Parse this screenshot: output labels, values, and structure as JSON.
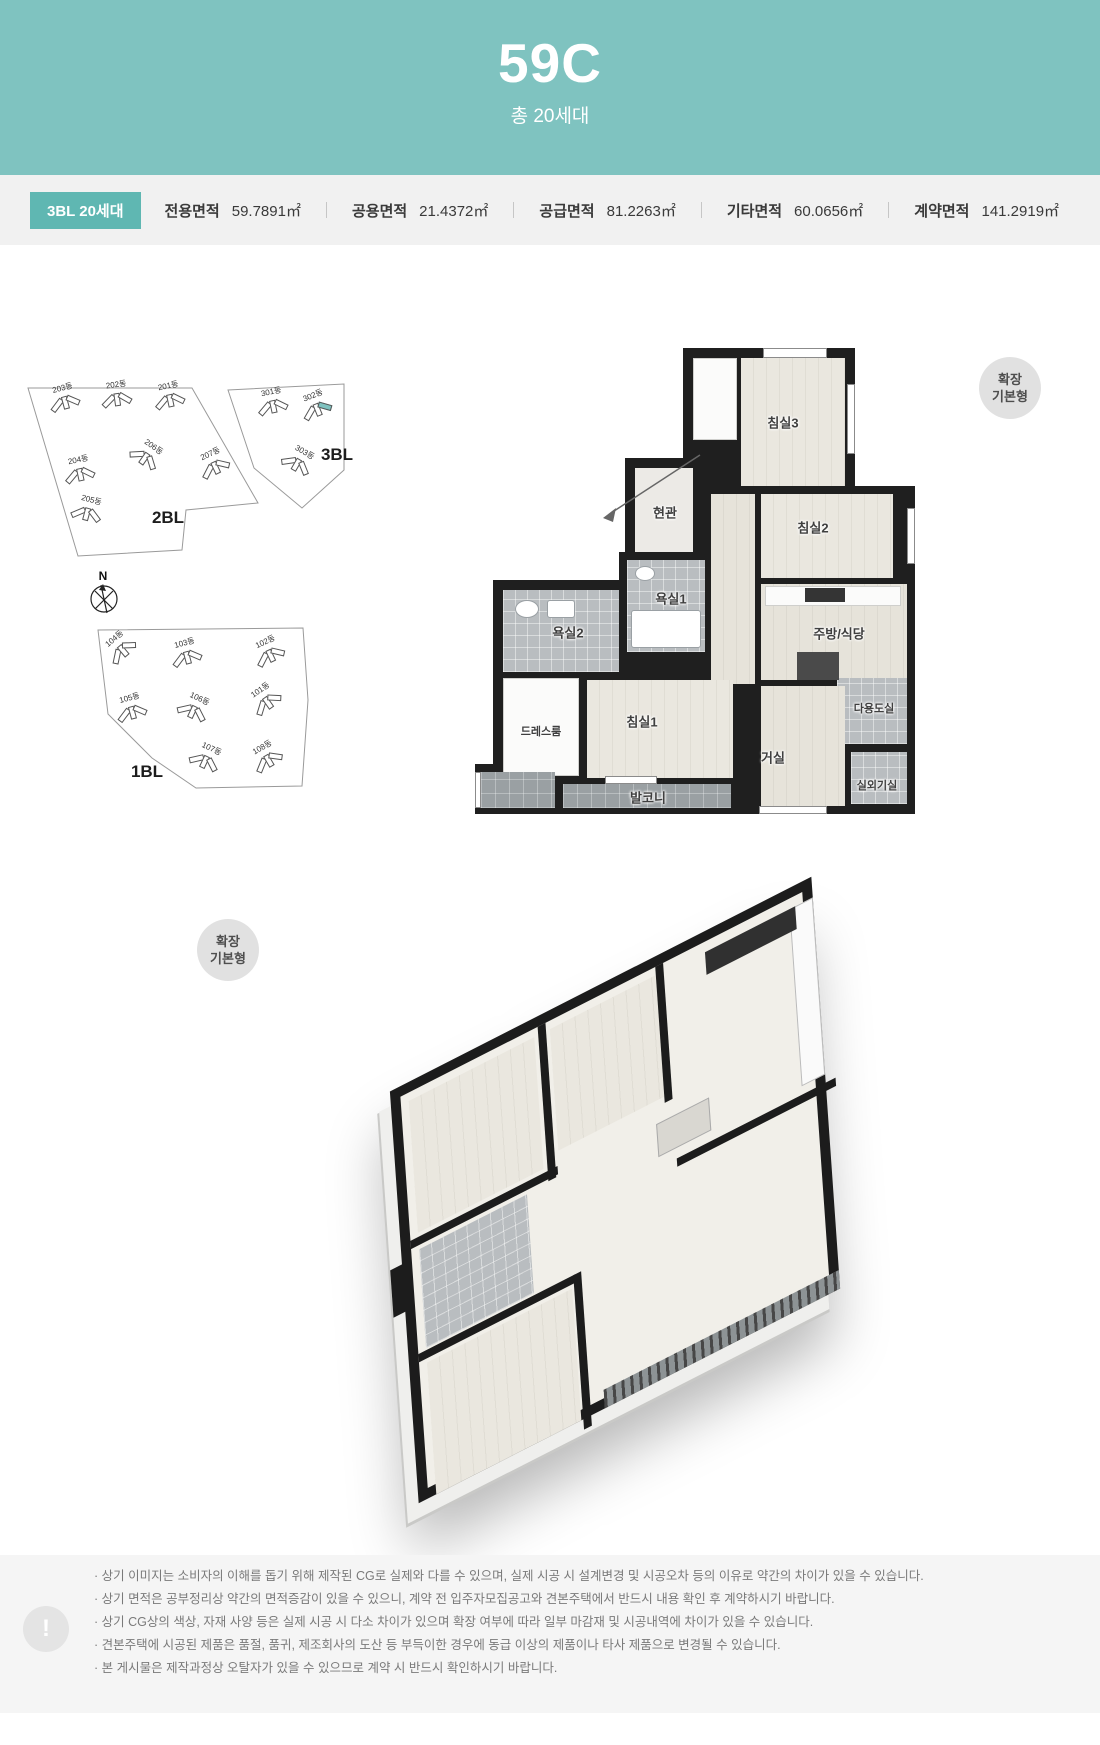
{
  "header": {
    "unit_type": "59C",
    "total_units": "총 20세대"
  },
  "summary": {
    "badge": "3BL 20세대",
    "items": [
      {
        "label": "전용면적",
        "value": "59.7891㎡"
      },
      {
        "label": "공용면적",
        "value": "21.4372㎡"
      },
      {
        "label": "공급면적",
        "value": "81.2263㎡"
      },
      {
        "label": "기타면적",
        "value": "60.0656㎡"
      },
      {
        "label": "계약면적",
        "value": "141.2919㎡"
      }
    ]
  },
  "site_plan": {
    "compass": "N",
    "blocks": [
      {
        "name": "2BL",
        "buildings": [
          {
            "label": "201동"
          },
          {
            "label": "202동"
          },
          {
            "label": "203동"
          },
          {
            "label": "204동"
          },
          {
            "label": "205동"
          },
          {
            "label": "206동"
          },
          {
            "label": "207동"
          }
        ]
      },
      {
        "name": "3BL",
        "highlighted": "302동",
        "buildings": [
          {
            "label": "301동"
          },
          {
            "label": "302동"
          },
          {
            "label": "303동"
          }
        ]
      },
      {
        "name": "1BL",
        "buildings": [
          {
            "label": "101동"
          },
          {
            "label": "102동"
          },
          {
            "label": "103동"
          },
          {
            "label": "104동"
          },
          {
            "label": "105동"
          },
          {
            "label": "106동"
          },
          {
            "label": "107동"
          },
          {
            "label": "108동"
          }
        ]
      }
    ]
  },
  "plan2d": {
    "badge": {
      "line1": "확장",
      "line2": "기본형"
    },
    "rooms": [
      {
        "label": "침실3"
      },
      {
        "label": "현관"
      },
      {
        "label": "침실2"
      },
      {
        "label": "욕실1"
      },
      {
        "label": "욕실2"
      },
      {
        "label": "주방/식당"
      },
      {
        "label": "다용도실"
      },
      {
        "label": "드레스룸"
      },
      {
        "label": "침실1"
      },
      {
        "label": "거실"
      },
      {
        "label": "발코니"
      },
      {
        "label": "실외기실"
      }
    ]
  },
  "plan3d": {
    "badge": {
      "line1": "확장",
      "line2": "기본형"
    }
  },
  "footer": {
    "icon": "!",
    "notes": [
      "· 상기 이미지는 소비자의 이해를 돕기 위해 제작된 CG로 실제와 다를 수 있으며, 실제 시공 시 설계변경 및 시공오차 등의 이유로 약간의 차이가 있을 수 있습니다.",
      "· 상기 면적은 공부정리상 약간의 면적증감이 있을 수 있으니, 계약 전 입주자모집공고와 견본주택에서 반드시 내용 확인 후 계약하시기 바랍니다.",
      "· 상기 CG상의 색상, 자재 사양 등은 실제 시공 시 다소 차이가 있으며 확장 여부에 따라 일부 마감재 및 시공내역에 차이가 있을 수 있습니다.",
      "· 견본주택에 시공된 제품은 품절, 품귀, 제조회사의 도산 등 부득이한 경우에 동급 이상의 제품이나 타사 제품으로 변경될 수 있습니다.",
      "· 본 게시물은 제작과정상 오탈자가 있을 수 있으므로 계약 시 반드시 확인하시기 바랍니다."
    ]
  },
  "colors": {
    "teal": "#7fc3c0",
    "badge_teal": "#5fb7b2",
    "band_gray": "#f1f1f1",
    "footer_gray": "#f5f5f5",
    "wall": "#1f1f1f",
    "wood": "#e6e3da",
    "tile": "#b9bdc0",
    "balcony": "#9aa0a3",
    "label": "#3f3f3f"
  }
}
